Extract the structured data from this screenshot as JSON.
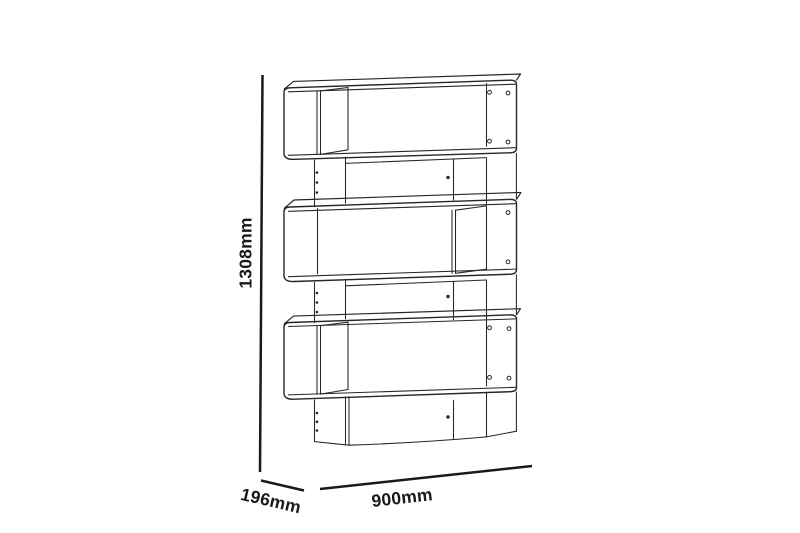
{
  "canvas": {
    "background": "#ffffff",
    "drawing_line_color": "#262626",
    "dimension_line_color": "#1a1a1a"
  },
  "dimensions": {
    "height": "1308mm",
    "depth": "196mm",
    "width": "900mm"
  }
}
